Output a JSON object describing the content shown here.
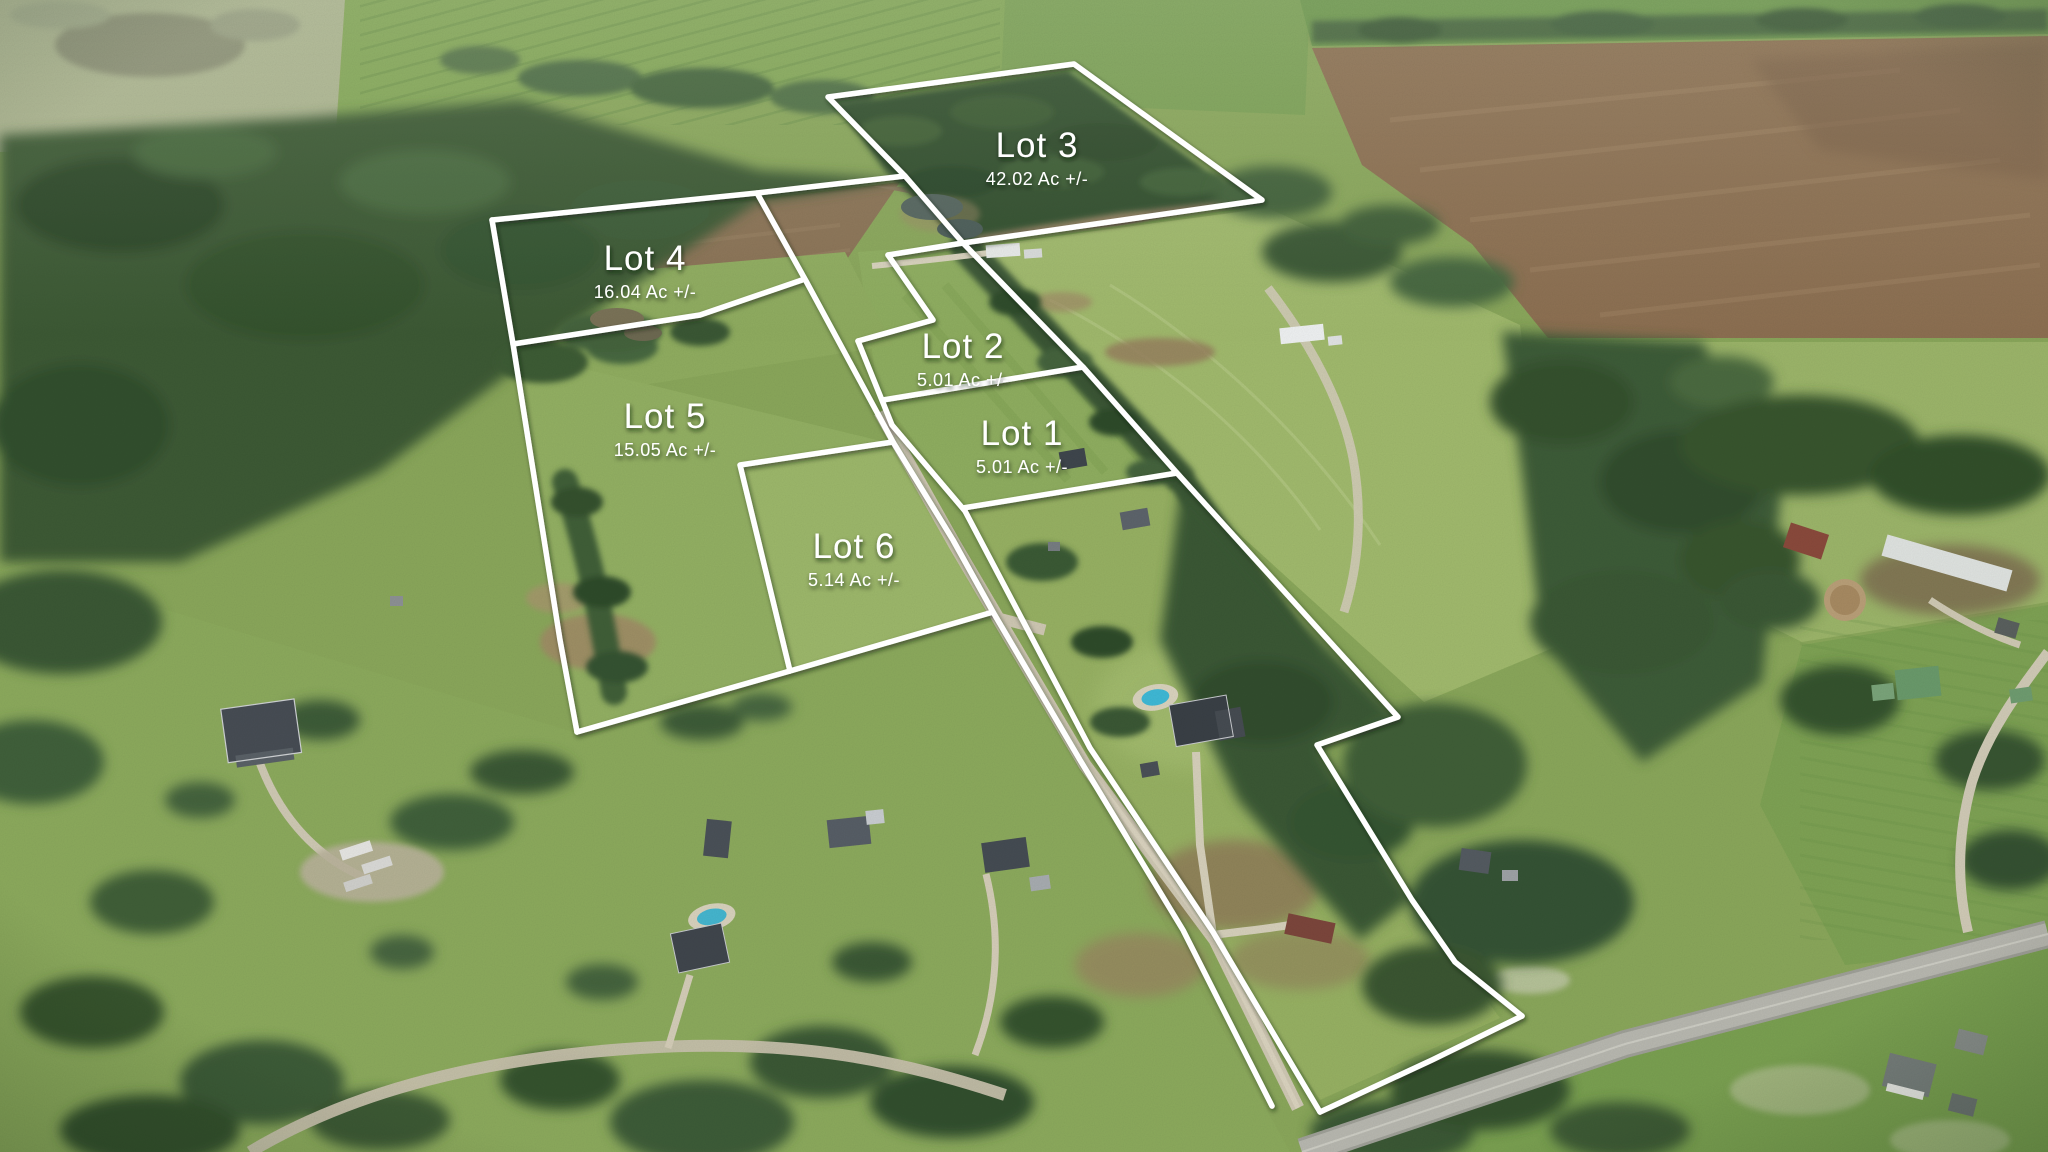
{
  "image": {
    "kind": "aerial-drone-photo-with-lot-overlay",
    "width": 2048,
    "height": 1152,
    "description": "Aerial view of rural farmland subdivided into six outlined lots for sale"
  },
  "overlay": {
    "boundary_color": "#ffffff",
    "label_color": "#ffffff",
    "paths": [
      {
        "name": "lot-3-outline",
        "d": "M828,97 L1074,64 L1262,200 L963,243 L905,176 Z"
      },
      {
        "name": "lot-4-north-edge",
        "d": "M492,220 L757,193 L905,176"
      },
      {
        "name": "west-boundary",
        "d": "M492,220 L513,344 L560,640 L577,732"
      },
      {
        "name": "lot-4-lot-5-divider",
        "d": "M513,344 L700,315 L802,280"
      },
      {
        "name": "access-corridor-west-edge",
        "d": "M757,193 L806,281 L893,442 L953,540 L993,612 L1080,760 L1183,930 L1272,1106"
      },
      {
        "name": "lot-5-lot-6-south-edge",
        "d": "M577,732 L790,671 L993,612"
      },
      {
        "name": "lot-6-outline",
        "d": "M790,671 L740,465 L893,442"
      },
      {
        "name": "lot-2-north-edge",
        "d": "M888,255 L963,243"
      },
      {
        "name": "lot-2-west-jog",
        "d": "M888,255 L933,320 L858,341"
      },
      {
        "name": "access-corridor-east-edge",
        "d": "M858,341 L892,425 L965,511 L1090,748 L1213,932 L1320,1112"
      },
      {
        "name": "lot-2-lot-1-divider",
        "d": "M883,400 L1083,367"
      },
      {
        "name": "lot-1-south-edge",
        "d": "M963,508 L1177,473"
      },
      {
        "name": "east-boundary-treeline",
        "d": "M963,243 L1083,367 L1177,473 L1398,717 L1317,745 L1412,900 L1455,962 L1522,1016"
      },
      {
        "name": "south-boundary-along-road",
        "d": "M1320,1112 L1432,1060 L1522,1016"
      }
    ]
  },
  "lots": [
    {
      "id": "lot-1",
      "name": "Lot 1",
      "acreage": "5.01 Ac +/-",
      "label_x": 1022,
      "label_y": 445
    },
    {
      "id": "lot-2",
      "name": "Lot 2",
      "acreage": "5.01 Ac +/-",
      "label_x": 963,
      "label_y": 358
    },
    {
      "id": "lot-3",
      "name": "Lot 3",
      "acreage": "42.02 Ac +/-",
      "label_x": 1037,
      "label_y": 157
    },
    {
      "id": "lot-4",
      "name": "Lot 4",
      "acreage": "16.04 Ac +/-",
      "label_x": 645,
      "label_y": 270
    },
    {
      "id": "lot-5",
      "name": "Lot 5",
      "acreage": "15.05 Ac +/-",
      "label_x": 665,
      "label_y": 428
    },
    {
      "id": "lot-6",
      "name": "Lot 6",
      "acreage": "5.14 Ac +/-",
      "label_x": 854,
      "label_y": 558
    }
  ]
}
